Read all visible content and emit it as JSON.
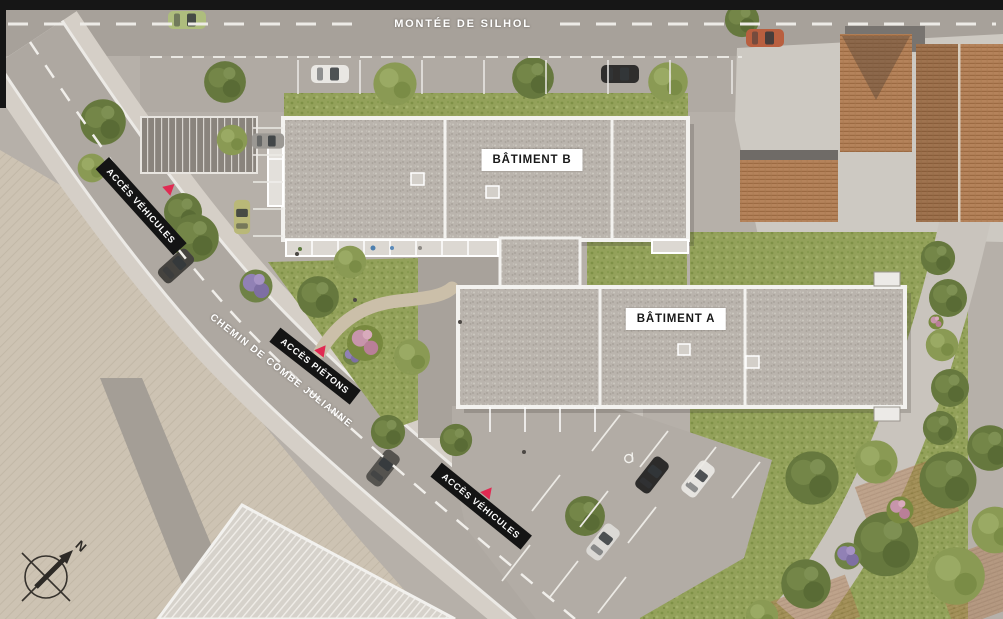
{
  "site_plan": {
    "streets": {
      "top": {
        "label": "MONTÉE DE SILHOL"
      },
      "west": {
        "label": "CHEMIN DE COMBE JULIANNE"
      }
    },
    "buildings": {
      "b": {
        "label": "BÂTIMENT B"
      },
      "a": {
        "label": "BÂTIMENT A"
      }
    },
    "access": {
      "vehicles_north": {
        "label": "ACCÈS VÉHICULES"
      },
      "pedestrians": {
        "label": "ACCÈS PIÉTONS"
      },
      "vehicles_south": {
        "label": "ACCÈS VÉHICULES"
      }
    },
    "compass": {
      "north": "N"
    },
    "icons": {
      "access_marker": "red-triangle",
      "compass": "north-arrow-circle"
    },
    "colors": {
      "label_background": "#141414",
      "label_text": "#ffffff",
      "building_label_background": "#ffffff",
      "building_label_text": "#181818",
      "access_marker": "#e02a52",
      "roof_gravel": "#bab4ad",
      "roof_terracotta": "#b5835b",
      "lawn": "#93a15a",
      "road": "#aea8a1",
      "neighbor_parcel": "#cdc9c2",
      "south_parcel": "#cdc3b3"
    }
  }
}
